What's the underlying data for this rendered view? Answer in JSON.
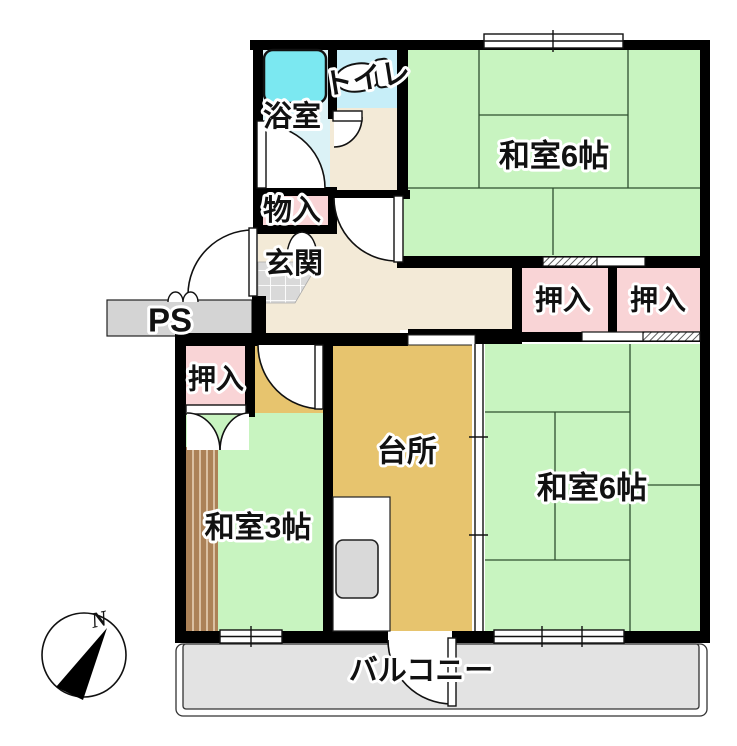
{
  "plan_type": "apartment-floor-plan",
  "rooms": {
    "bathroom": {
      "label": "浴室"
    },
    "toilet": {
      "label": "トイレ"
    },
    "storage": {
      "label": "物入"
    },
    "entrance": {
      "label": "玄関"
    },
    "pipe_space": {
      "label": "PS"
    },
    "closet_hall": {
      "label": "押入"
    },
    "closet_center": {
      "label": "押入"
    },
    "closet_right": {
      "label": "押入"
    },
    "kitchen": {
      "label": "台所"
    },
    "japanese_room_3": {
      "label": "和室3帖"
    },
    "japanese_room_6_upper": {
      "label": "和室6帖"
    },
    "japanese_room_6_right": {
      "label": "和室6帖"
    },
    "balcony": {
      "label": "バルコニー"
    }
  },
  "compass": {
    "north_label": "N"
  },
  "colors": {
    "tatami_green": "#c8f4c0",
    "closet_pink": "#f9d4d6",
    "kitchen_tan": "#e7c46e",
    "hallway_beige": "#f3ead7",
    "toilet_blue": "#c7eef8",
    "bathroom_blue": "#dbf2f6",
    "bathtub_cyan": "#7be8f1",
    "balcony_gray": "#e3e3e3",
    "ps_gray": "#d4d4d4",
    "wood_brown": "#ab8157",
    "wall_black": "#000000"
  }
}
